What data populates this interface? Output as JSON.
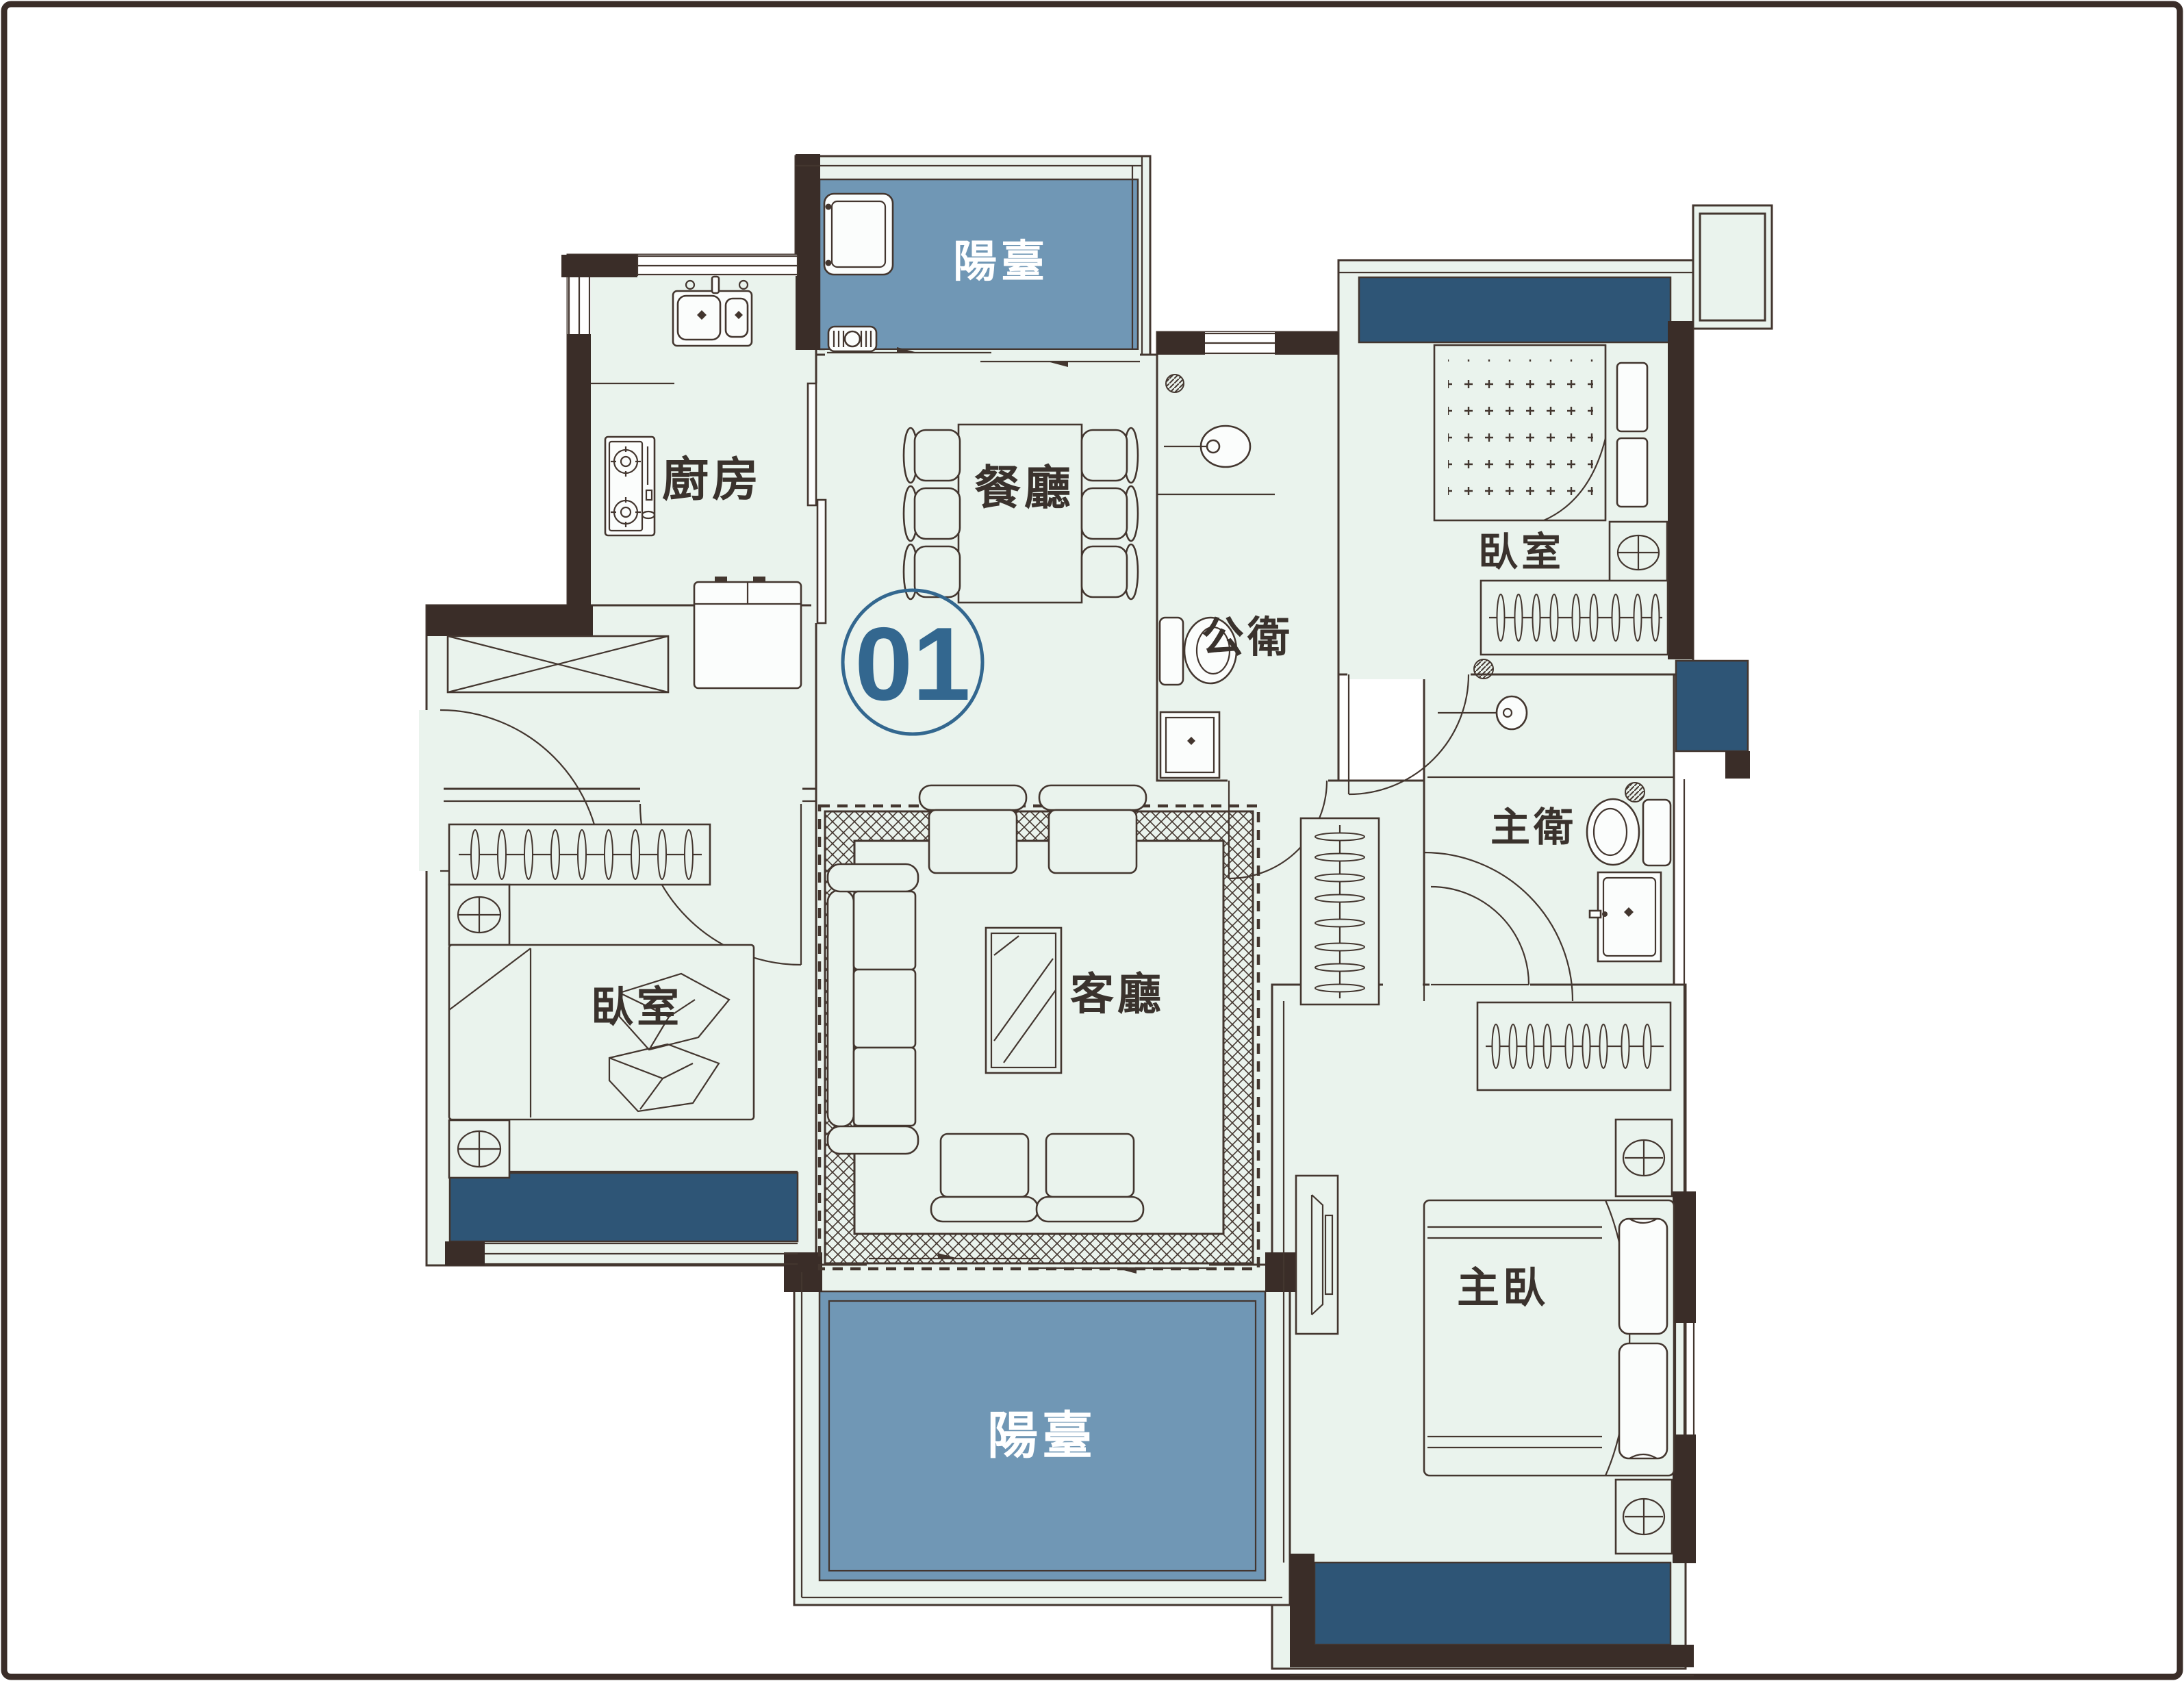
{
  "unit": {
    "number": "01"
  },
  "rooms": {
    "balcony_top": "陽臺",
    "kitchen": "廚房",
    "dining": "餐廳",
    "public_bath": "公衛",
    "bedroom_right": "臥室",
    "master_bath": "主衛",
    "bedroom_left": "臥室",
    "living": "客廳",
    "master_bedroom": "主臥",
    "balcony_bottom": "陽臺"
  },
  "colors": {
    "floor": "#eaf3ed",
    "wall": "#3a2d28",
    "line": "#43362f",
    "balcony_fill": "#7097b5",
    "bay_window_fill": "#2e5576",
    "label": "#3a322d",
    "accent": "#33678f",
    "balcony_text": "#ffffff"
  }
}
